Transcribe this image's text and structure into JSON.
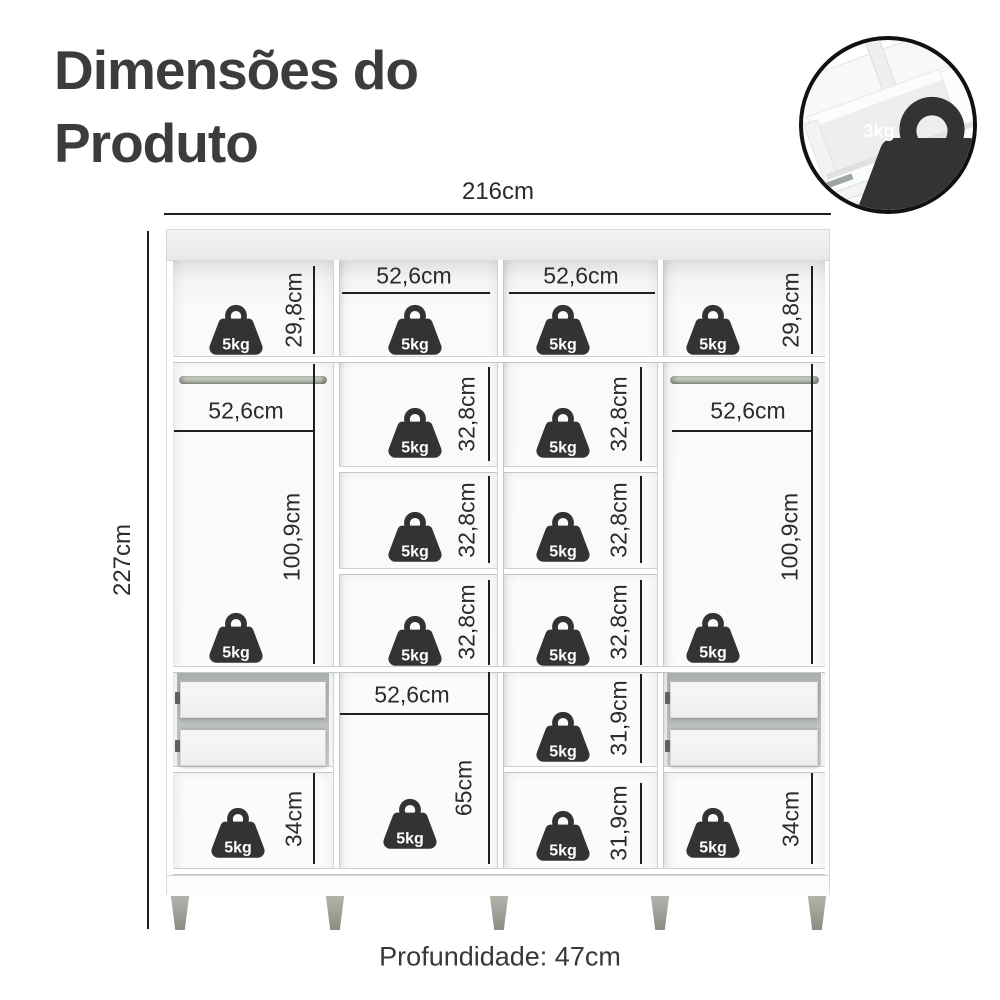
{
  "title": {
    "line1": "Dimensões do",
    "line2": "Produto"
  },
  "overall": {
    "width": "216cm",
    "height": "227cm",
    "depth": "Profundidade: 47cm"
  },
  "compartments": {
    "section_width": "52,6cm",
    "top_row_height": "29,8cm",
    "shelf_height": "32,8cm",
    "hanging_height": "100,9cm",
    "middle_bottom_height": "65cm",
    "small_shelf_height": "31,9cm",
    "bottom_height": "34cm"
  },
  "weights": {
    "shelf_capacity": "5kg",
    "drawer_capacity": "3kg"
  },
  "colors": {
    "dimension_line": "#1f1f1f",
    "icon": "#333333",
    "title_text": "#3c3c3c",
    "label_text": "#2b2b2b"
  }
}
